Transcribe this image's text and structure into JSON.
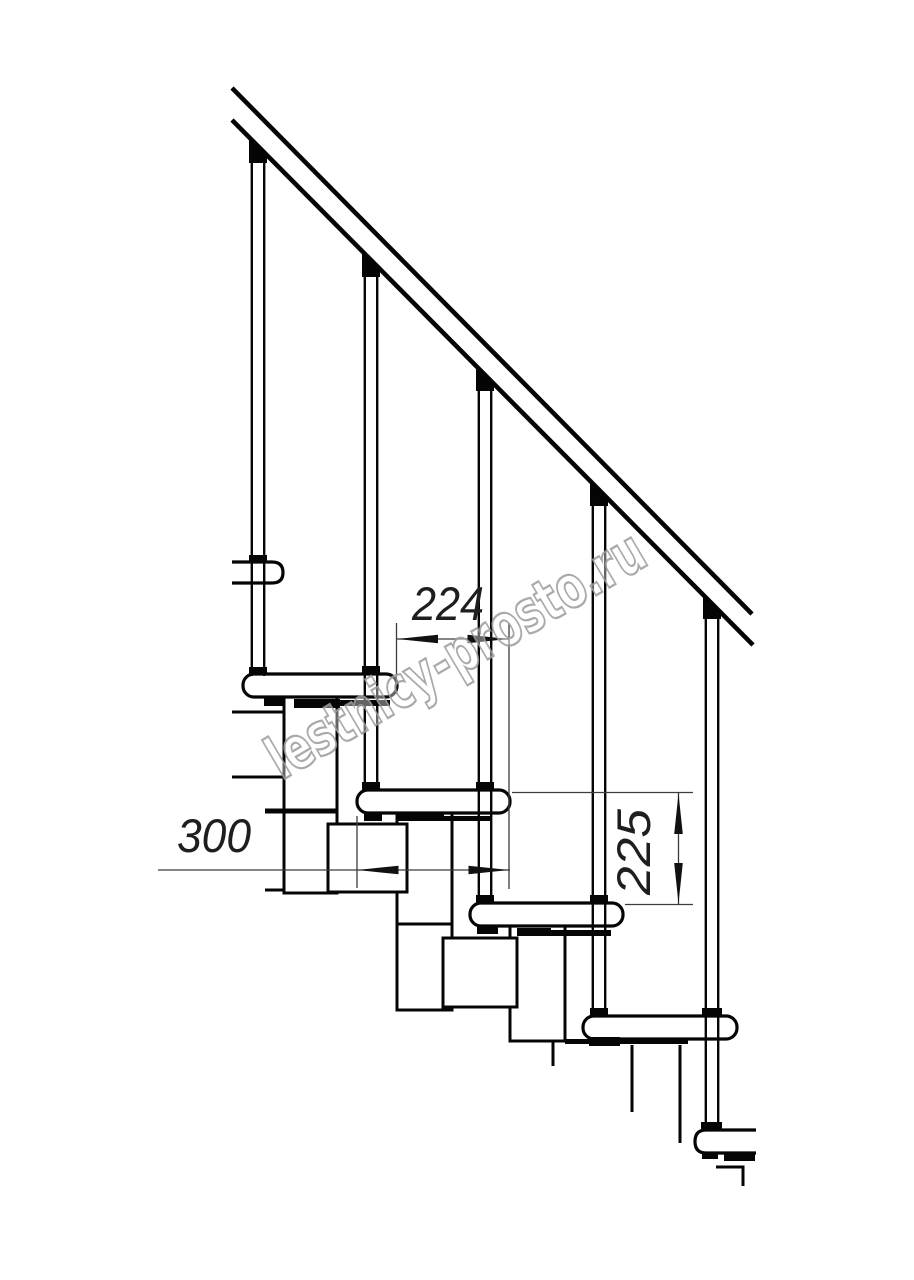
{
  "drawing": {
    "description": "Modular staircase side-view technical drawing",
    "stroke_color": "#050505",
    "dimension_line_color": "#3c3c3c",
    "dimension_labels": {
      "run_224": "224",
      "depth_300": "300",
      "rise_225": "225"
    }
  },
  "watermark": {
    "text": "lestnicy-prosto.ru",
    "color": "#9b9b9b"
  }
}
